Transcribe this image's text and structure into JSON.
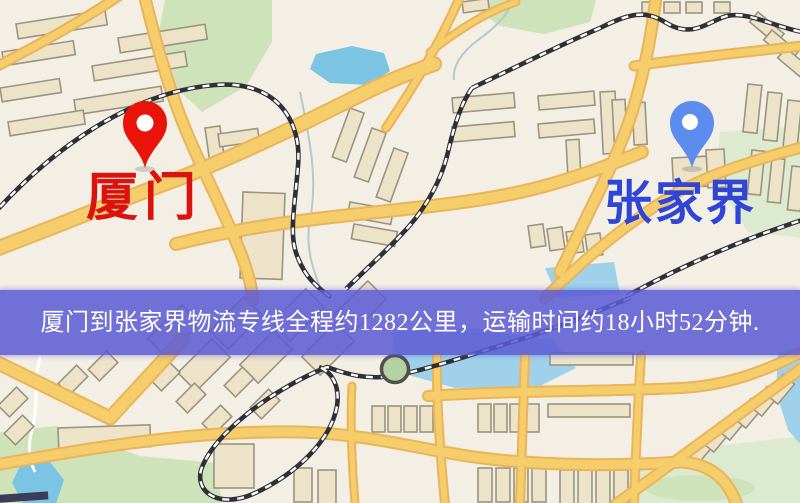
{
  "map": {
    "origin": {
      "label": "厦门"
    },
    "destination": {
      "label": "张家界"
    },
    "banner": {
      "text": "厦门到张家界物流专线全程约1282公里，运输时间约18小时52分钟."
    }
  },
  "route": {
    "origin": "厦门",
    "destination": "张家界",
    "distance_text": "约1282公里",
    "duration_text": "约18小时52分钟"
  },
  "colors": {
    "map_background": "#f3efe4",
    "road": "#f5cd6a",
    "road_edge": "#eab45a",
    "building_fill": "#ece3c8",
    "building_stroke": "#9a9480",
    "park": "#cfe3bb",
    "park_light": "#dcead0",
    "water": "#9fd2ea",
    "water_deep": "#7cc4e4",
    "railway": "#2f2f38",
    "origin_pin": "#e81409",
    "origin_label": "#dc120f",
    "destination_pin": "#5b8cee",
    "destination_label": "#2f45d6",
    "banner_background": "#5c5cd6",
    "banner_text": "#ffffff"
  }
}
